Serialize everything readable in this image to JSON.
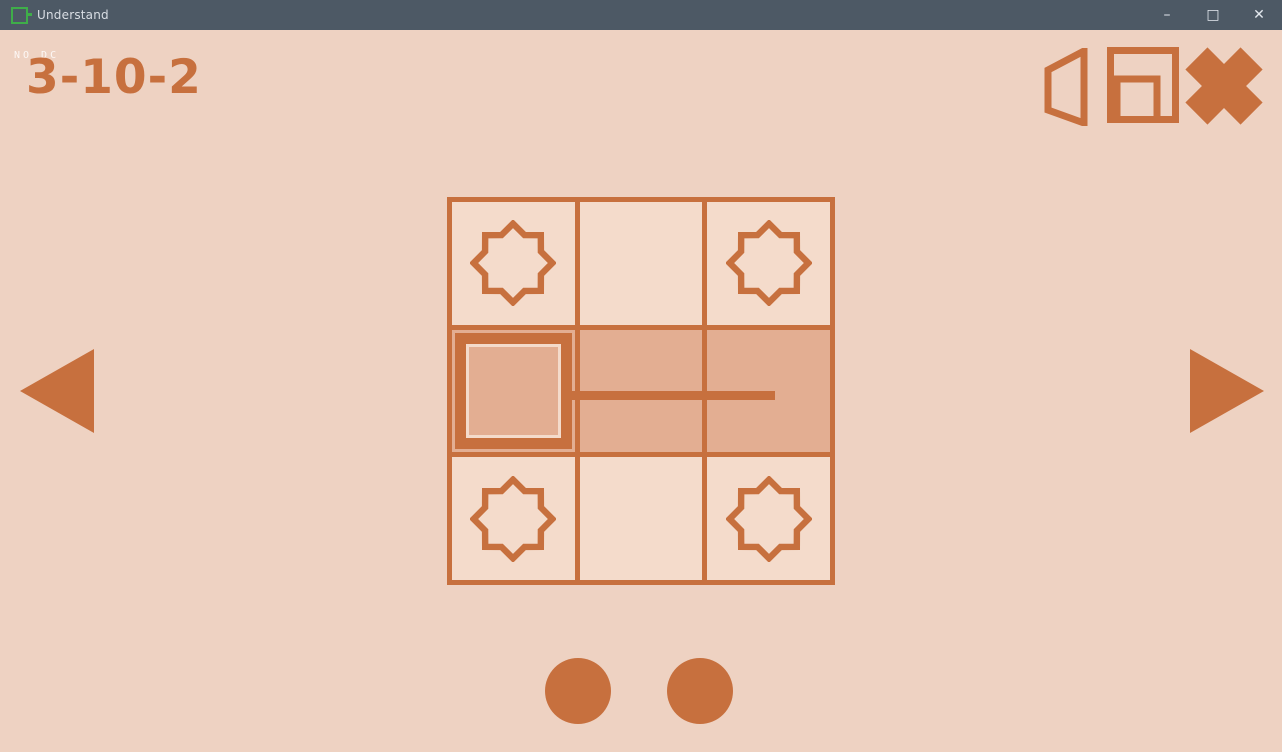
{
  "window": {
    "title": "Understand",
    "controls": [
      {
        "name": "minimize",
        "glyph": "–"
      },
      {
        "name": "maximize",
        "glyph": "□"
      },
      {
        "name": "close",
        "glyph": "✕"
      }
    ]
  },
  "colors": {
    "accent": "#c7703e",
    "background": "#eed2c2",
    "cell": "#f4dbcb",
    "shaded_cell": "#e3ae92",
    "titlebar": "#4d5965",
    "logo_green": "#3fae49"
  },
  "hud": {
    "overlay_label": "NO DC",
    "level_id": "3-10-2"
  },
  "toolbar": {
    "icons": [
      {
        "name": "sound"
      },
      {
        "name": "window-mode"
      },
      {
        "name": "exit"
      }
    ]
  },
  "board": {
    "rows": 3,
    "cols": 3,
    "cells": [
      [
        "star",
        "empty",
        "star"
      ],
      [
        "piece",
        "shaded",
        "shaded"
      ],
      [
        "star",
        "empty",
        "star"
      ]
    ],
    "line": {
      "row": 1,
      "start_col": 0,
      "end_col": 2,
      "end_fraction": 0.5
    }
  },
  "pager": {
    "dot_count": 2
  }
}
